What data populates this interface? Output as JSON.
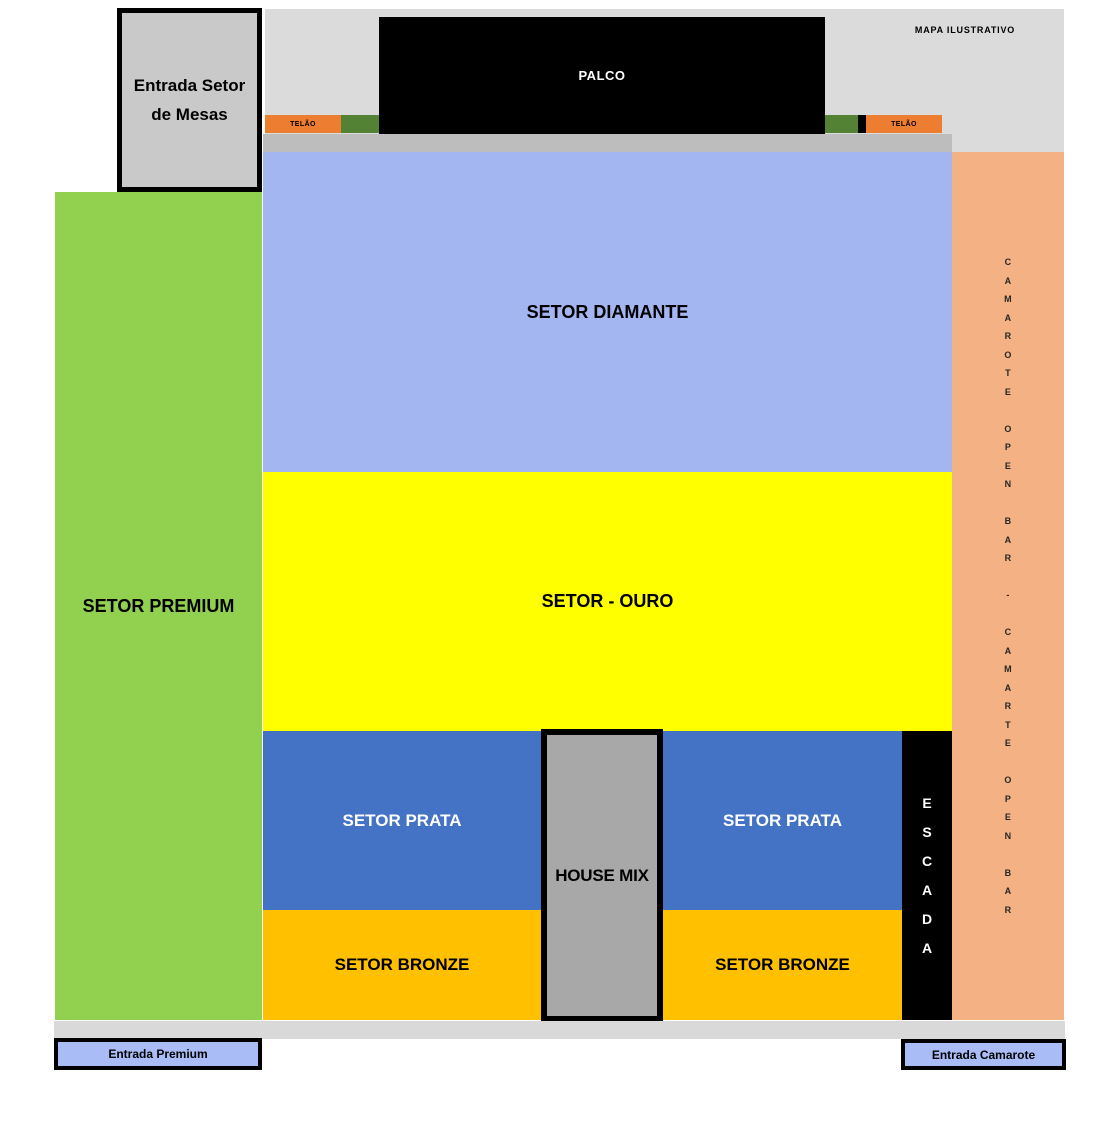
{
  "map": {
    "title": "MAPA ILUSTRATIVO",
    "stage": {
      "label": "PALCO",
      "color": "#000000"
    },
    "screens": {
      "left_label": "TELÃO",
      "right_label": "TELÃO",
      "color": "#ED7D31",
      "side_panel_color": "#548235"
    },
    "sectors": {
      "diamante": {
        "label": "SETOR DIAMANTE",
        "color": "#A4B6F2"
      },
      "ouro": {
        "label": "SETOR - OURO",
        "color": "#FFFF00"
      },
      "prata_left": {
        "label": "SETOR PRATA",
        "color": "#4472C4"
      },
      "prata_right": {
        "label": "SETOR PRATA",
        "color": "#4472C4"
      },
      "bronze_left": {
        "label": "SETOR BRONZE",
        "color": "#FFC000"
      },
      "bronze_right": {
        "label": "SETOR BRONZE",
        "color": "#FFC000"
      },
      "premium": {
        "label": "SETOR PREMIUM",
        "color": "#92D050"
      },
      "house_mix": {
        "label": "HOUSE MIX",
        "color": "#A8A8A8"
      },
      "escada": {
        "vertical_label": "E\nS\nC\nA\nD\nA",
        "color": "#000000"
      },
      "camarote": {
        "vertical_label": "C\nA\nM\nA\nR\nO\nT\nE\n\nO\nP\nE\nN\n\nB\nA\nR\n\n-\n\nC\nA\nM\nA\nR\nT\nE\n\nO\nP\nE\nN\n\nB\nA\nR",
        "color": "#F4B183"
      }
    },
    "entrances": {
      "mesas": {
        "label": "Entrada Setor\nde Mesas"
      },
      "premium": {
        "label": "Entrada Premium"
      },
      "camarote": {
        "label": "Entrada Camarote"
      }
    }
  }
}
